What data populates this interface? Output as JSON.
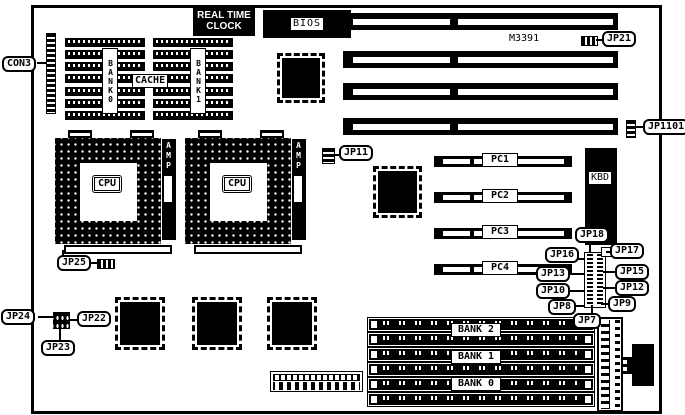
{
  "colors": {
    "ink": "#000000",
    "paper": "#ffffff"
  },
  "callouts": {
    "con3": "CON3",
    "jp25": "JP25",
    "jp11": "JP11",
    "jp21": "JP21",
    "jp1101": "JP1101",
    "jp18": "JP18",
    "jp17": "JP17",
    "jp16": "JP16",
    "jp15": "JP15",
    "jp13": "JP13",
    "jp12": "JP12",
    "jp10": "JP10",
    "jp9": "JP9",
    "jp8": "JP8",
    "jp7": "JP7",
    "jp24": "JP24",
    "jp23": "JP23",
    "jp22": "JP22"
  },
  "chips": {
    "rtc_line1": "REAL TIME",
    "rtc_line2": "CLOCK",
    "bios": "BIOS",
    "m3391": "M3391",
    "cache_label": "CACHE",
    "cache_bank0": "BANK0",
    "cache_bank1": "BANK1",
    "cpu1": "CPU",
    "cpu2": "CPU",
    "amp1": "AMP",
    "amp2": "AMP",
    "kbd": "KBD"
  },
  "slots": {
    "pc1": "PC1",
    "pc2": "PC2",
    "pc3": "PC3",
    "pc4": "PC4"
  },
  "memory": {
    "bank2": "BANK 2",
    "bank1": "BANK 1",
    "bank0": "BANK 0"
  }
}
